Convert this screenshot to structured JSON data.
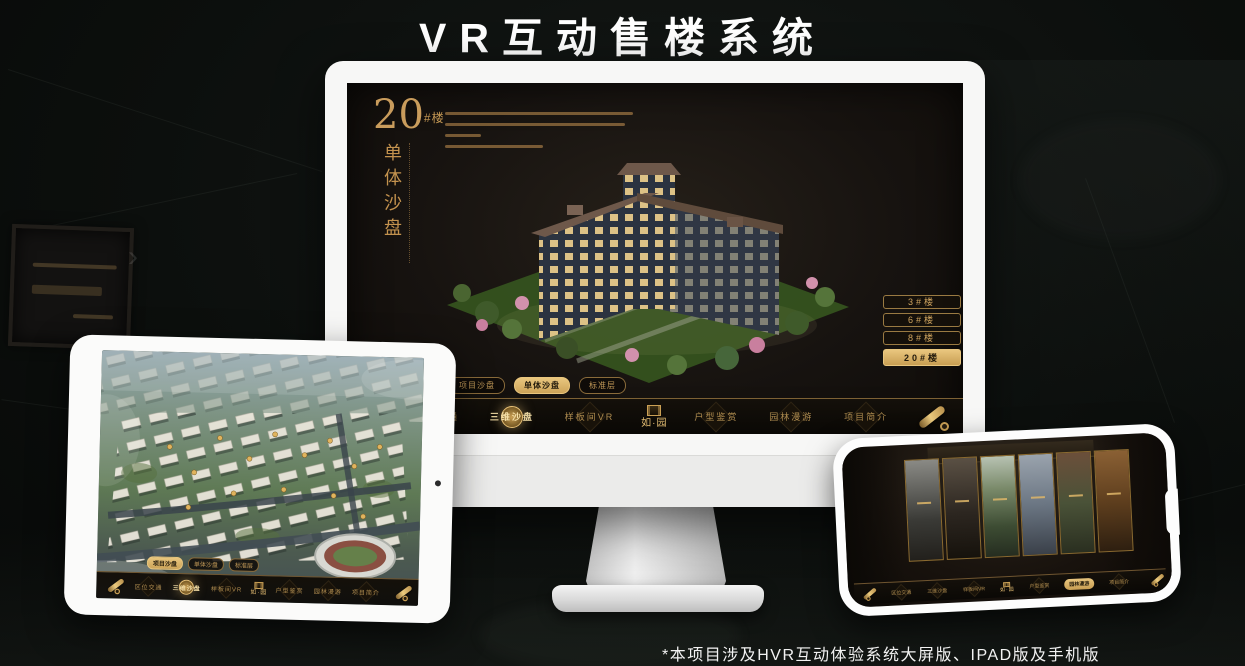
{
  "header": {
    "title": "VR互动售楼系统"
  },
  "footer": {
    "note": "*本项目涉及HVR互动体验系统大屏版、IPAD版及手机版"
  },
  "monitor_screen": {
    "block_number": "20",
    "block_unit": "#楼",
    "block_title": "单体沙盘",
    "floor_buttons": [
      "3#楼",
      "6#楼",
      "8#楼",
      "20#楼"
    ],
    "floor_active": "20#楼",
    "tab_active": "单体沙盘"
  },
  "tablet_screen": {
    "tab_active": "项目沙盘",
    "nav_active": "三维沙盘"
  },
  "phone_screen": {
    "nav_active": "园林漫游"
  },
  "layer_tabs": [
    "项目沙盘",
    "单体沙盘",
    "标准层"
  ],
  "nav": {
    "items": [
      "区位交通",
      "三维沙盘",
      "样板间VR",
      "户型鉴赏",
      "园林漫游",
      "项目简介"
    ],
    "logo": "如·园",
    "monitor_active": "三维沙盘"
  },
  "colors": {
    "gold": "#c99c5c",
    "gold_bright": "#e8c177",
    "active_bg": "#d9b267",
    "screen_bg": "#15110d"
  }
}
